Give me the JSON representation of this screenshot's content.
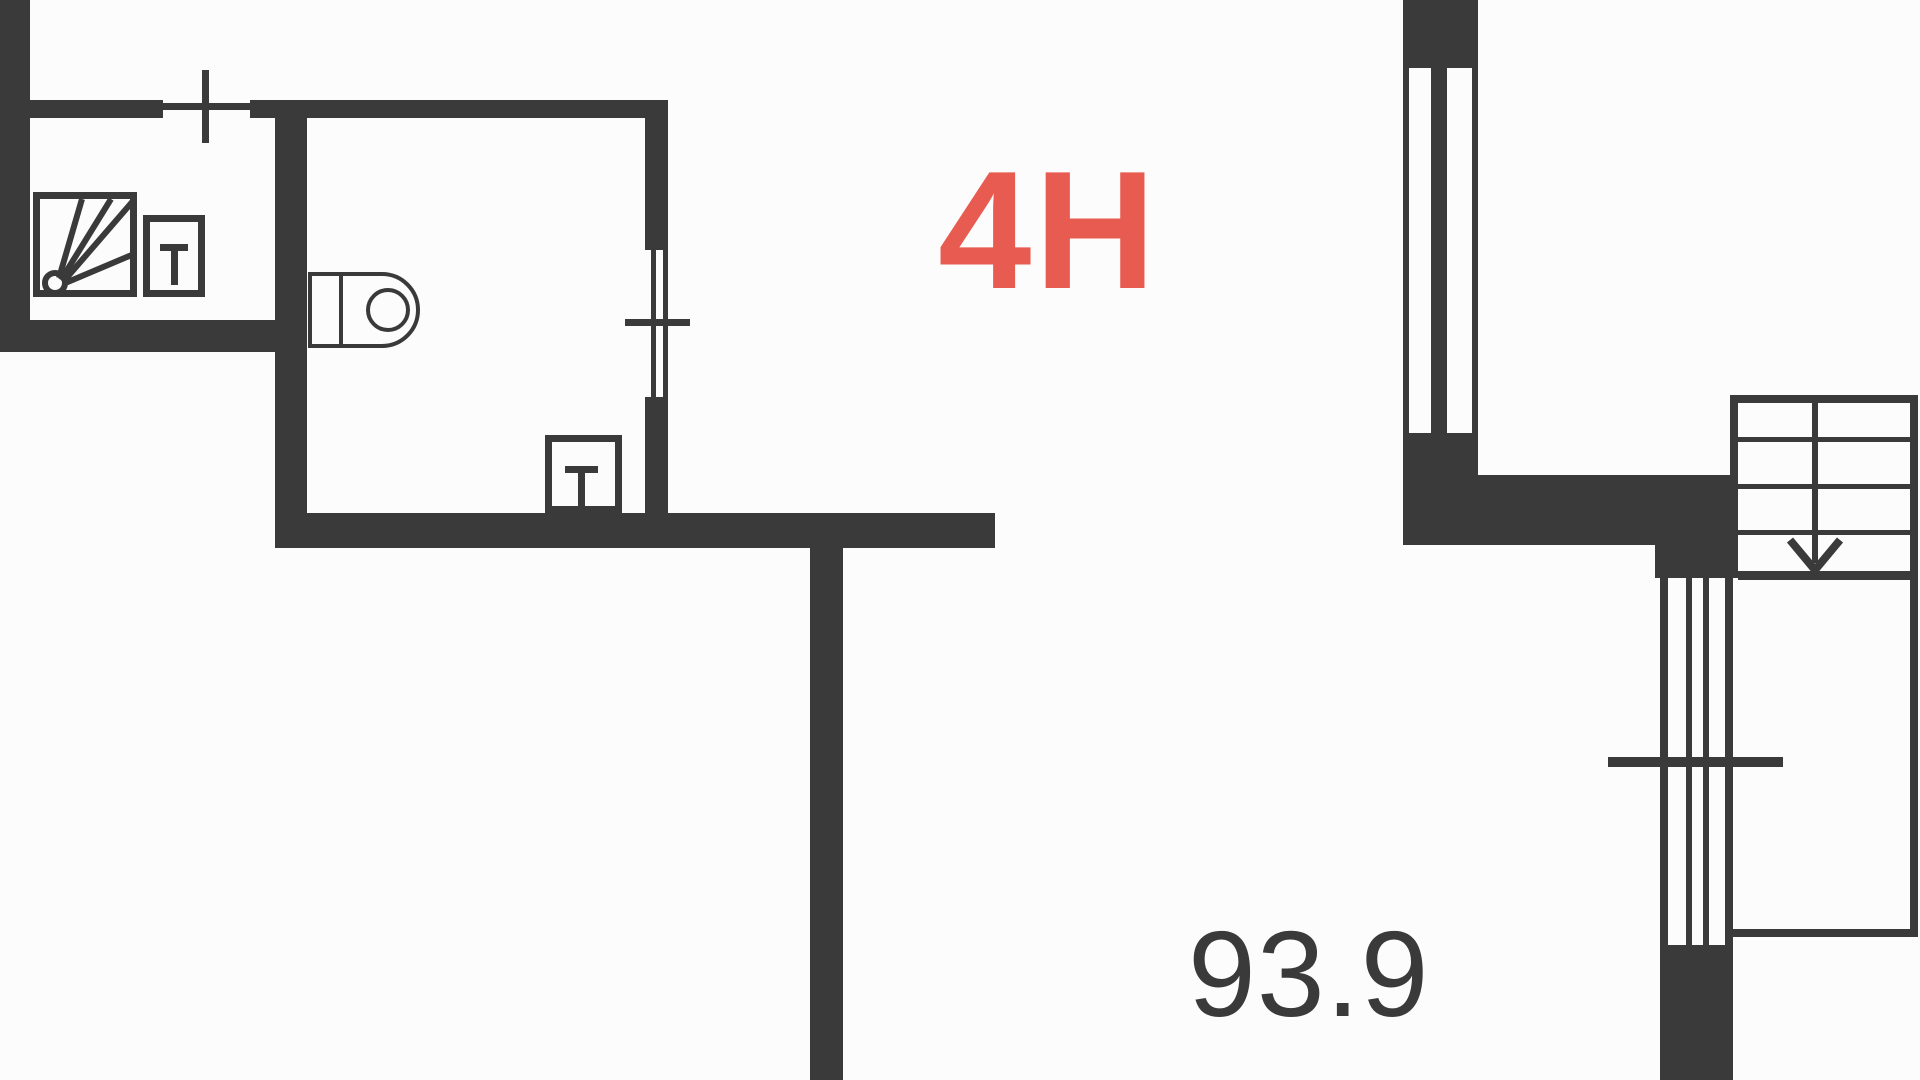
{
  "colors": {
    "wall": "#3a3a3a",
    "accent": "#e85b50",
    "bg": "#fcfcfc"
  },
  "floorplan": {
    "unit_label": "4H",
    "area_label": "93.9",
    "fixtures": [
      {
        "icon": "shower-icon",
        "room": "bathroom"
      },
      {
        "icon": "washbasin-icon",
        "room": "bathroom"
      },
      {
        "icon": "toilet-icon",
        "room": "wc"
      },
      {
        "icon": "washbasin-icon",
        "room": "wc"
      },
      {
        "icon": "window-icon",
        "count": 4
      },
      {
        "icon": "staircase-icon",
        "direction": "down"
      }
    ]
  }
}
